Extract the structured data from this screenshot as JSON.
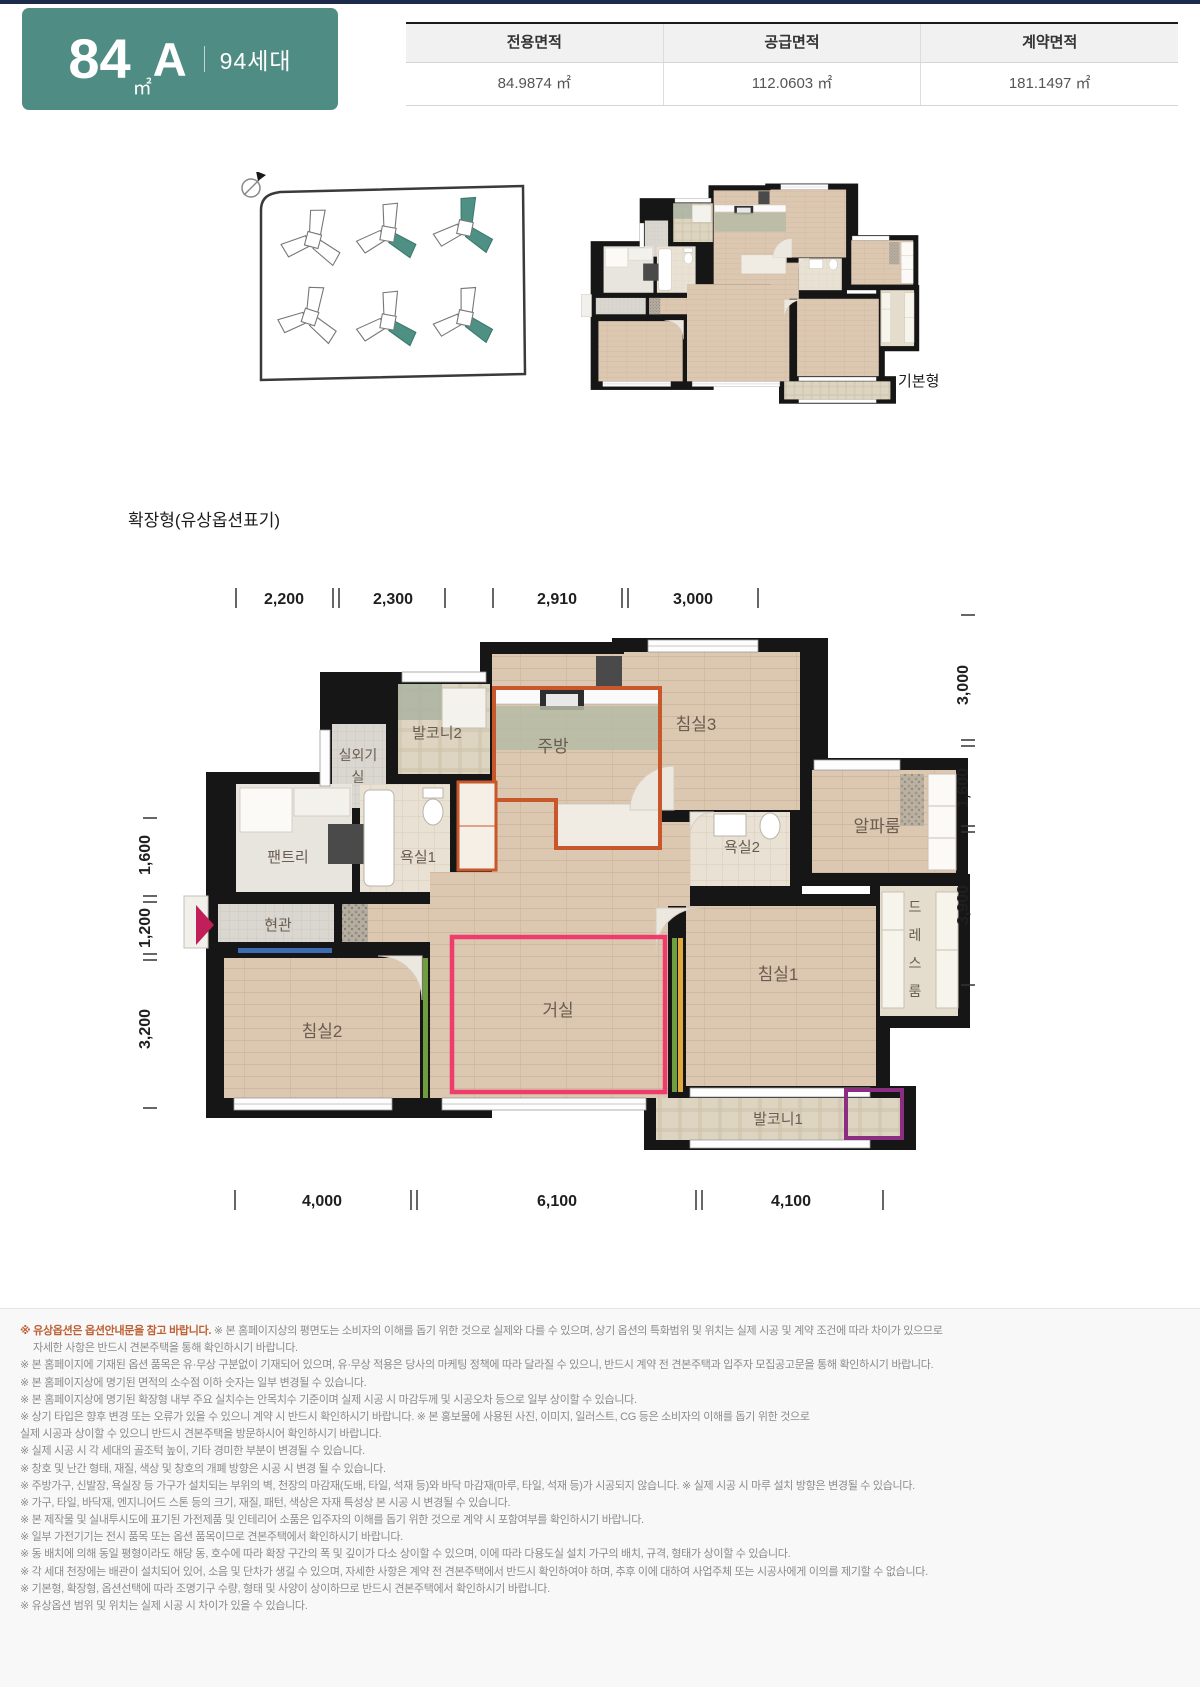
{
  "header": {
    "badge": {
      "area": "84",
      "unit": "㎡",
      "type": "A",
      "households": "94세대"
    },
    "table": {
      "columns": [
        "전용면적",
        "공급면적",
        "계약면적"
      ],
      "values": [
        "84.9874 ㎡",
        "112.0603 ㎡",
        "181.1497 ㎡"
      ]
    }
  },
  "basic_plan": {
    "label": "기본형"
  },
  "expanded_plan": {
    "title": "확장형(유상옵션표기)",
    "dims_top": [
      "2,200",
      "2,300",
      "2,910",
      "3,000"
    ],
    "dims_bottom": [
      "4,000",
      "6,100",
      "4,100"
    ],
    "dims_left": [
      "1,600",
      "1,200",
      "3,200"
    ],
    "dims_right": [
      "3,000",
      "1,600",
      "3,900"
    ],
    "rooms": {
      "outdoor_unit_1": "실외기",
      "outdoor_unit_2": "실",
      "balcony2": "발코니2",
      "kitchen": "주방",
      "bedroom3": "침실3",
      "alpha_room": "알파룸",
      "bath1": "욕실1",
      "bath2": "욕실2",
      "pantry": "팬트리",
      "entrance": "현관",
      "bedroom2": "침실2",
      "living": "거실",
      "bedroom1": "침실1",
      "dress_chars": [
        "드",
        "레",
        "스",
        "룸"
      ],
      "balcony1": "발코니1"
    },
    "colors": {
      "paid_option_orange": "#c8572b",
      "living_mark_pink": "#ee3d6d",
      "balcony_mark_purple": "#8b2e82",
      "entry_arrow_magenta": "#c21e5a",
      "green_mark": "#6f9e3f",
      "yellow_mark": "#e2aa3c",
      "blue_mark": "#3c6cb4",
      "site_highlight_teal": "#4e9184"
    }
  },
  "notes": {
    "lead": "※ 유상옵션은 옵션안내문을 참고 바랍니다.",
    "lead_rest": " ※ 본 홈페이지상의 평면도는 소비자의 이해를 돕기 위한 것으로 실제와 다를 수 있으며, 상기 옵션의 특화범위 및 위치는 실제 시공 및 계약 조건에 따라 차이가 있으므로",
    "lines": [
      "자세한 사항은 반드시 견본주택을 통해 확인하시기 바랍니다.",
      "※ 본 홈페이지에 기재된 옵션 품목은 유·무상 구분없이 기재되어 있으며, 유·무상 적용은 당사의 마케팅 정책에 따라 달라질 수 있으니, 반드시 계약 전 견본주택과 입주자 모집공고문을 통해 확인하시기 바랍니다.",
      "※ 본 홈페이지상에 명기된 면적의 소수점 이하 숫자는 일부 변경될 수 있습니다.",
      "※ 본 홈페이지상에 명기된 확장형 내부 주요 실치수는 안목치수 기준이며 실제 시공 시 마감두께 및 시공오차 등으로 일부 상이할 수 있습니다.",
      "※ 상기 타입은 향후 변경 또는 오류가 있을 수 있으니 계약 시 반드시 확인하시기 바랍니다. ※ 본 홍보물에 사용된 사진, 이미지, 일러스트, CG 등은 소비자의 이해를 돕기 위한 것으로",
      "실제 시공과 상이할 수 있으니 반드시 견본주택을 방문하시어 확인하시기 바랍니다.",
      "※ 실제 시공 시 각 세대의 골조턱 높이, 기타 경미한 부분이 변경될 수 있습니다.",
      "※ 창호 및 난간 형태, 재질, 색상 및 창호의 개폐 방향은 시공 시 변경 될 수 있습니다.",
      "※ 주방가구, 신발장, 욕실장 등 가구가 설치되는 부위의 벽, 천장의 마감재(도배, 타일, 석재 등)와 바닥 마감재(마루, 타일, 석재 등)가 시공되지 않습니다. ※ 실제 시공 시 마루 설치 방향은 변경될 수 있습니다.",
      "※ 가구, 타일, 바닥재, 엔지니어드 스톤 등의 크기, 재질, 패턴, 색상은 자재 특성상 본 시공 시 변경될 수 있습니다.",
      "※ 본 제작물 및 실내투시도에 표기된 가전제품 및 인테리어 소품은 입주자의 이해를 돕기 위한 것으로 계약 시 포함여부를 확인하시기 바랍니다.",
      "※ 일부 가전기기는 전시 품목 또는 옵션 품목이므로 견본주택에서 확인하시기 바랍니다.",
      "※ 동 배치에 의해 동일 평형이라도 해당 동, 호수에 따라 확장 구간의 폭 및 깊이가 다소 상이할 수 있으며, 이에 따라 다용도실 설치 가구의 배치, 규격, 형태가 상이할 수 있습니다.",
      "※ 각 세대 천장에는 배관이 설치되어 있어, 소음 및 단차가 생길 수 있으며, 자세한 사항은 계약 전 견본주택에서 반드시 확인하여야 하며, 추후 이에 대하여 사업주체 또는 시공사에게 이의를 제기할 수 없습니다.",
      "※ 기본형, 확장형, 옵션선택에 따라 조명기구 수량, 형태 및 사양이 상이하므로 반드시 견본주택에서 확인하시기 바랍니다.",
      "※ 유상옵션 범위 및 위치는 실제 시공 시 차이가 있을 수 있습니다."
    ]
  }
}
